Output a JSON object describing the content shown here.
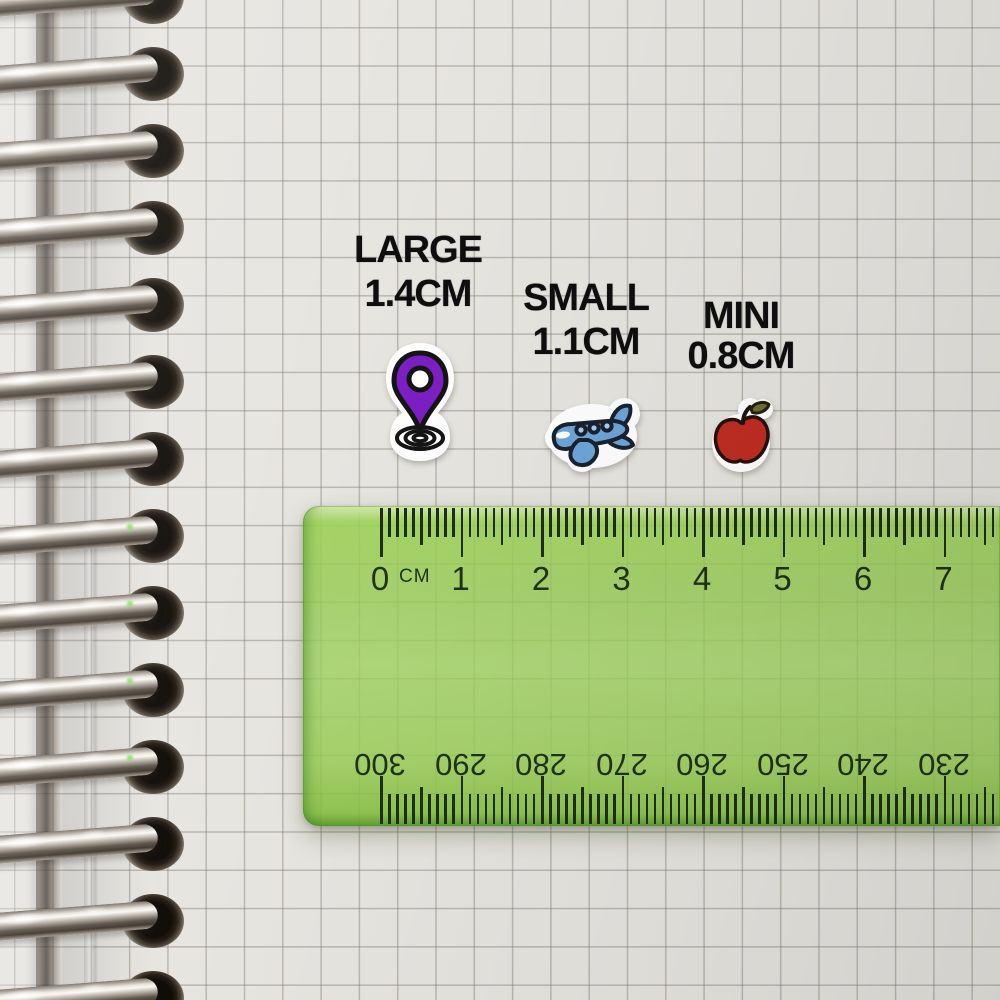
{
  "size_labels": [
    {
      "title": "LARGE",
      "size": "1.4CM"
    },
    {
      "title": "SMALL",
      "size": "1.1CM"
    },
    {
      "title": "MINI",
      "size": "0.8CM"
    }
  ],
  "stickers": [
    {
      "name": "location-pin-sticker",
      "color": "#7c1fc4"
    },
    {
      "name": "airplane-sticker",
      "color": "#6ca6d8"
    },
    {
      "name": "apple-sticker",
      "color": "#bf2d22"
    }
  ],
  "ruler": {
    "unit_label": "CM",
    "cm_numbers": [
      "0",
      "1",
      "2",
      "3",
      "4",
      "5",
      "6",
      "7"
    ],
    "mm_numbers": [
      "300",
      "290",
      "280",
      "270",
      "260",
      "250",
      "240",
      "230"
    ],
    "body_color": "#96cc50",
    "tick_color": "#1c2f13"
  }
}
